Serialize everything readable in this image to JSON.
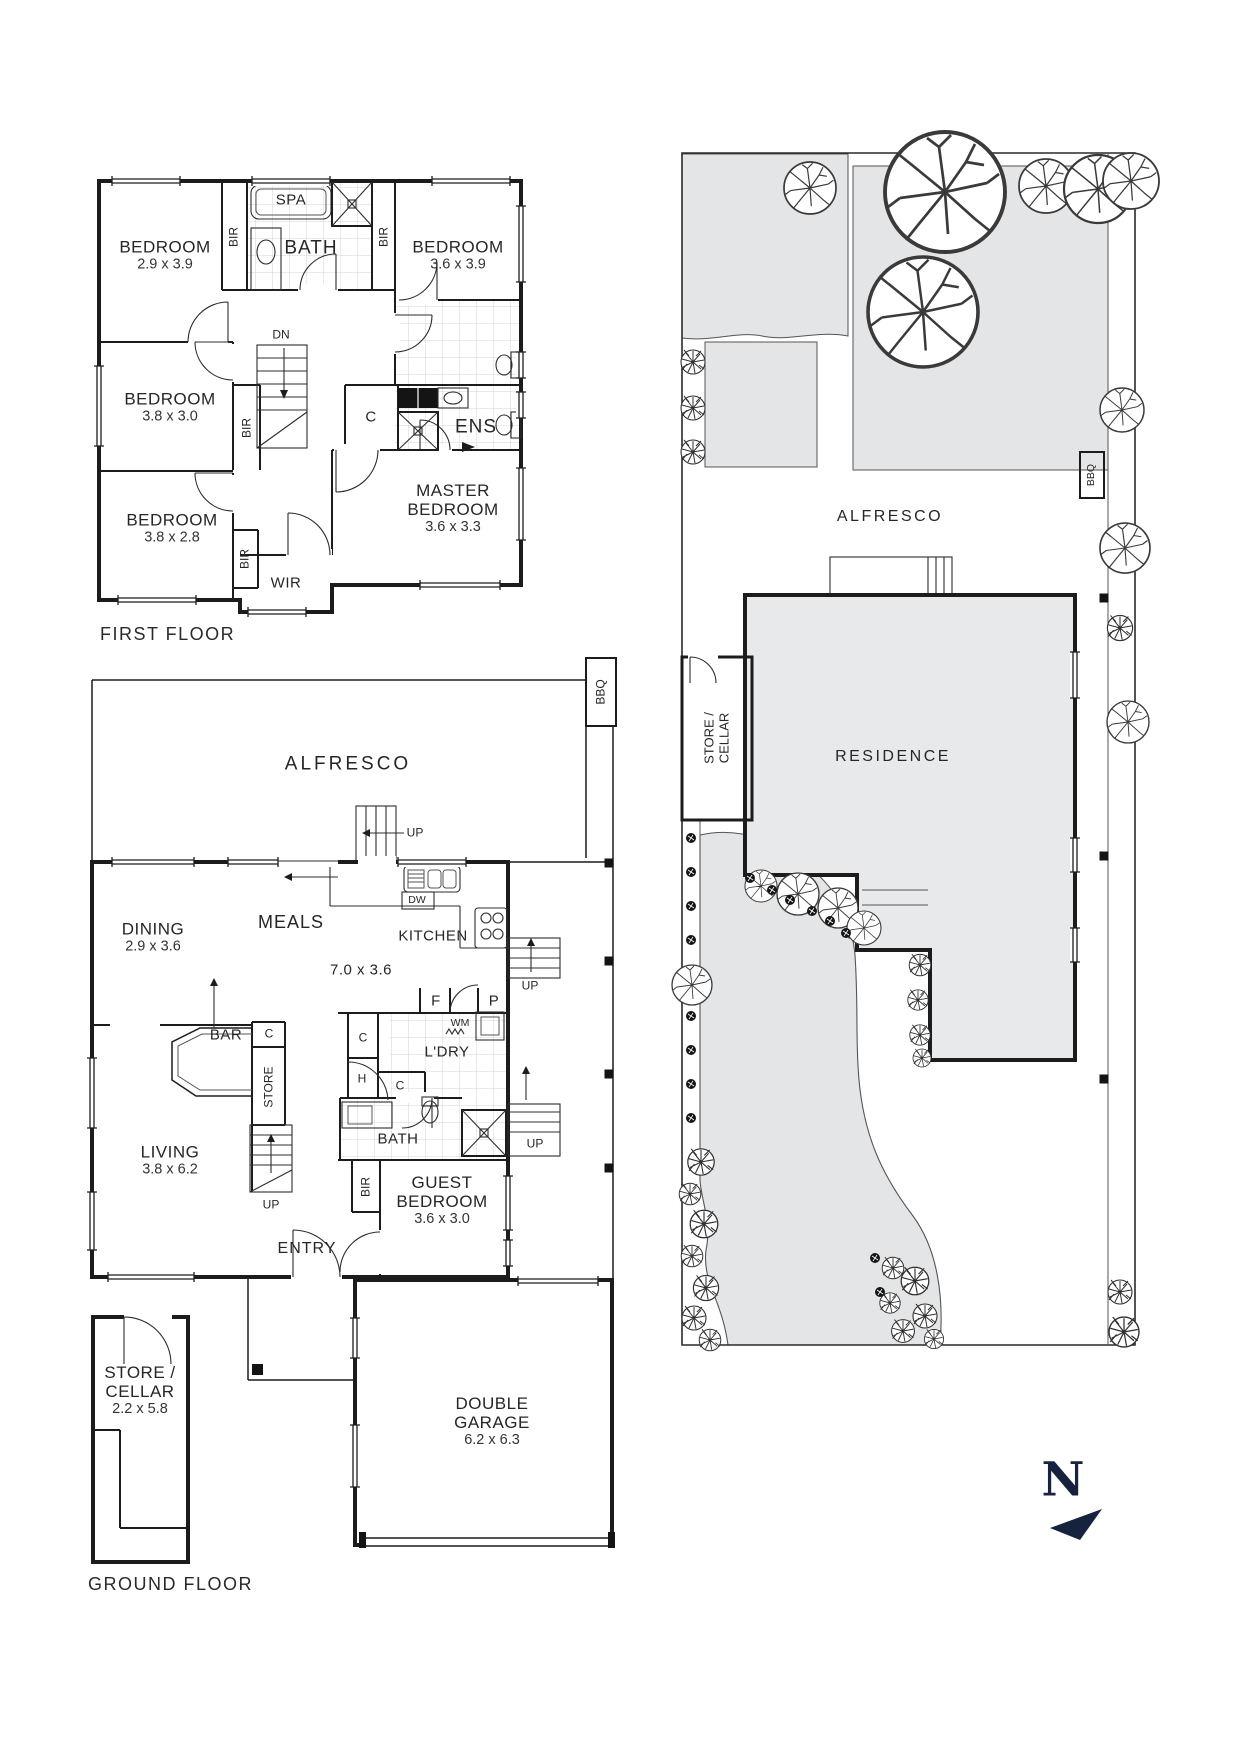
{
  "page": {
    "background": "#ffffff"
  },
  "colors": {
    "wall": "#1c1c1c",
    "gray_fill": "#e4e5e7",
    "residence_fill": "#e8e9eb",
    "navy": "#17233e"
  },
  "first_floor": {
    "title": "FIRST FLOOR",
    "bedroom1": {
      "name": "BEDROOM",
      "dims": "2.9 x 3.9"
    },
    "bedroom2": {
      "name": "BEDROOM",
      "dims": "3.6 x 3.9"
    },
    "bedroom3": {
      "name": "BEDROOM",
      "dims": "3.8 x 3.0"
    },
    "bedroom4": {
      "name": "BEDROOM",
      "dims": "3.8 x 2.8"
    },
    "master": {
      "name1": "MASTER",
      "name2": "BEDROOM",
      "dims": "3.6 x 3.3"
    },
    "bath": "BATH",
    "spa": "SPA",
    "ens": "ENS",
    "wir": "WIR",
    "bir": "BIR",
    "closet": "C",
    "down": "DN"
  },
  "ground_floor": {
    "title": "GROUND FLOOR",
    "alfresco": "ALFRESCO",
    "bbq": "BBQ",
    "up": "UP",
    "dining": {
      "name": "DINING",
      "dims": "2.9 x 3.6"
    },
    "meals": "MEALS",
    "kitchen": {
      "name": "KITCHEN",
      "dims": "7.0 x 3.6"
    },
    "dishwasher": "DW",
    "bar": "BAR",
    "store": "STORE",
    "closet": "C",
    "living": {
      "name": "LIVING",
      "dims": "3.8 x 6.2"
    },
    "fridge": "F",
    "pantry": "P",
    "washing_machine": "WM",
    "laundry": "L'DRY",
    "hot_water": "H",
    "bath": "BATH",
    "bir": "BIR",
    "guest": {
      "name1": "GUEST",
      "name2": "BEDROOM",
      "dims": "3.6 x 3.0"
    },
    "entry": "ENTRY",
    "store_cellar": {
      "name1": "STORE /",
      "name2": "CELLAR",
      "dims": "2.2 x 5.8"
    },
    "garage": {
      "name1": "DOUBLE",
      "name2": "GARAGE",
      "dims": "6.2 x 6.3"
    }
  },
  "site_plan": {
    "alfresco": "ALFRESCO",
    "bbq": "BBQ",
    "store_cellar": {
      "name1": "STORE /",
      "name2": "CELLAR"
    },
    "residence": "RESIDENCE",
    "north": "N"
  }
}
